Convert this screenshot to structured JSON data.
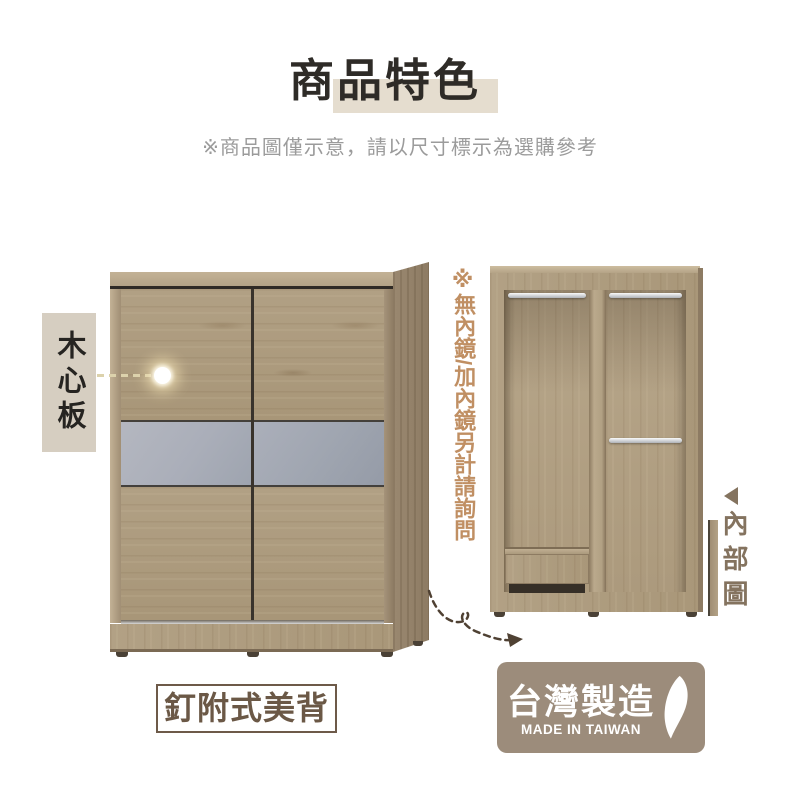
{
  "header": {
    "title": "商品特色",
    "subtitle": "※商品圖僅示意，請以尺寸標示為選購參考"
  },
  "annotations": {
    "material_label": "木心板",
    "mirror_note": "※無內鏡/加內鏡另計請詢問",
    "interior_label": "內部圖",
    "back_panel_label": "釘附式美背"
  },
  "badge": {
    "title": "台灣製造",
    "subtitle": "MADE IN TAIWAN"
  },
  "icons": {
    "interior_pointer": "left-triangle-icon",
    "taiwan_island": "taiwan-island-icon",
    "material_dot": "highlight-dot-icon",
    "flow_arrow": "dashed-curved-arrow-icon"
  },
  "colors": {
    "title_text": "#2e2b27",
    "title_highlight": "#e5ddcf",
    "subtitle_text": "#9b9b9b",
    "material_label_bg": "#d6cec1",
    "material_label_text": "#262421",
    "mirror_note_text": "#c08f63",
    "interior_label_text": "#84735f",
    "back_panel_border": "#6d5a49",
    "back_panel_text": "#6b5846",
    "badge_bg": "#9c8c7b",
    "badge_text": "#ffffff",
    "arrow": "#4f4133",
    "gray_panel_left": "#aaaeb9",
    "gray_panel_right": "#9fa5b0"
  }
}
